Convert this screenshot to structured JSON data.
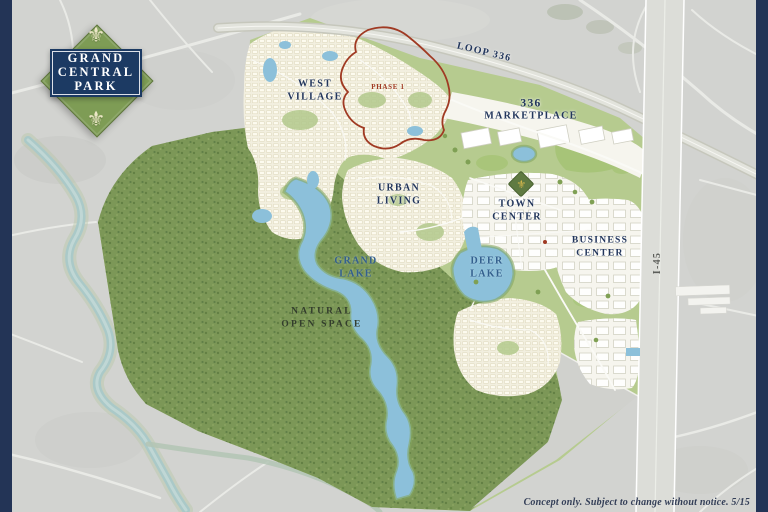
{
  "logo": {
    "line1": "GRAND",
    "line2": "CENTRAL",
    "line3": "PARK"
  },
  "icons": {
    "logo_fleur": "⚜",
    "town_center_fleur": "⚜"
  },
  "map_labels": {
    "west_village": {
      "line1": "WEST",
      "line2": "VILLAGE"
    },
    "phase_1": {
      "text": "PHASE 1"
    },
    "loop_336": {
      "text": "LOOP 336"
    },
    "marketplace_336": {
      "line1": "336",
      "line2": "MARKETPLACE"
    },
    "urban_living": {
      "line1": "URBAN",
      "line2": "LIVING"
    },
    "town_center": {
      "line1": "TOWN",
      "line2": "CENTER"
    },
    "business_center": {
      "line1": "BUSINESS",
      "line2": "CENTER"
    },
    "grand_lake": {
      "line1": "GRAND",
      "line2": "LAKE"
    },
    "deer_lake": {
      "line1": "DEER",
      "line2": "LAKE"
    },
    "natural_open_space": {
      "line1": "NATURAL",
      "line2": "OPEN SPACE"
    },
    "i_45": {
      "text": "I-45"
    }
  },
  "footer": {
    "disclaimer": "Concept only. Subject to change without notice. 5/15"
  },
  "colors": {
    "frame_navy": "#233456",
    "aerial_gray": "#d2d3d0",
    "plan_green": "#b6cb8f",
    "forest_green": "#7c9757",
    "lake_blue": "#8cc0da",
    "lake_label_blue": "#33608e",
    "label_navy": "#22365c",
    "phase_red": "#a03a23",
    "logo_green": "#7e9c55",
    "logo_navy": "#1c3a63",
    "cream_residential": "#f2efdf",
    "white_district": "#f6f5ee",
    "road_gray": "#dcddd8",
    "open_space_text": "#333d2c",
    "disclaimer_text": "#333e57"
  }
}
